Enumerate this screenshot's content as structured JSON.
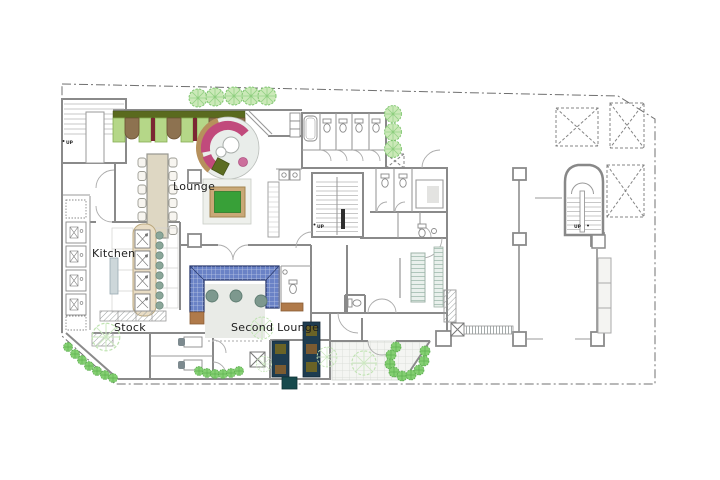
{
  "page": {
    "width": 720,
    "height": 480,
    "background": "#ffffff"
  },
  "plan": {
    "type": "architectural-floor-plan",
    "rooms": [
      {
        "id": "lounge",
        "label": "Lounge"
      },
      {
        "id": "kitchen",
        "label": "Kitchen"
      },
      {
        "id": "stock",
        "label": "Stock"
      },
      {
        "id": "second-lounge",
        "label": "Second Lounge"
      }
    ],
    "stairs": [
      {
        "id": "northwest-stair",
        "label": "UP"
      },
      {
        "id": "central-stair",
        "label": "UP"
      },
      {
        "id": "east-stair",
        "label": "UP"
      }
    ],
    "features": [
      "booth-seating-row",
      "round-sofa-lounge",
      "game-table",
      "dining-table-12-seats",
      "kitchen-counter-with-stools",
      "blue-u-banquette",
      "round-tables",
      "dark-booth-seats",
      "toilet-stalls",
      "bathtub-room",
      "elevator-voids",
      "trees-and-bushes",
      "tiled-entry-plaza"
    ],
    "palette": {
      "wall": "#8a8a8a",
      "boundary": "#707070",
      "tree_fill": "#cbe9b8",
      "tree_stroke": "#7cc46c",
      "bush_fill": "#84cf72",
      "bench_green": "#b5d788",
      "bench_band_olive": "#5a6a1e",
      "booth_table_brown": "#8d7250",
      "booth_divider_maroon": "#7b2733",
      "sofa_pink": "#c14a7c",
      "sofa_tan": "#b6905c",
      "ottoman_olive": "#5c6d22",
      "game_table_green": "#38a038",
      "game_table_trim": "#c9a877",
      "dining_table_beige": "#ded7c3",
      "counter_beige": "#e9ddc5",
      "stool_sage": "#8ba79a",
      "banquette_blue": "#6a82c6",
      "banquette_border_navy": "#2a3a6e",
      "round_table_gray_green": "#7d988e",
      "accent_brown": "#b07a4a",
      "booth_navy": "#1e3c50",
      "booth_olive": "#6a6326",
      "booth_brown": "#7b5b31",
      "planter_teal": "#174a4d",
      "rug_gray": "#e9ebe7"
    }
  }
}
